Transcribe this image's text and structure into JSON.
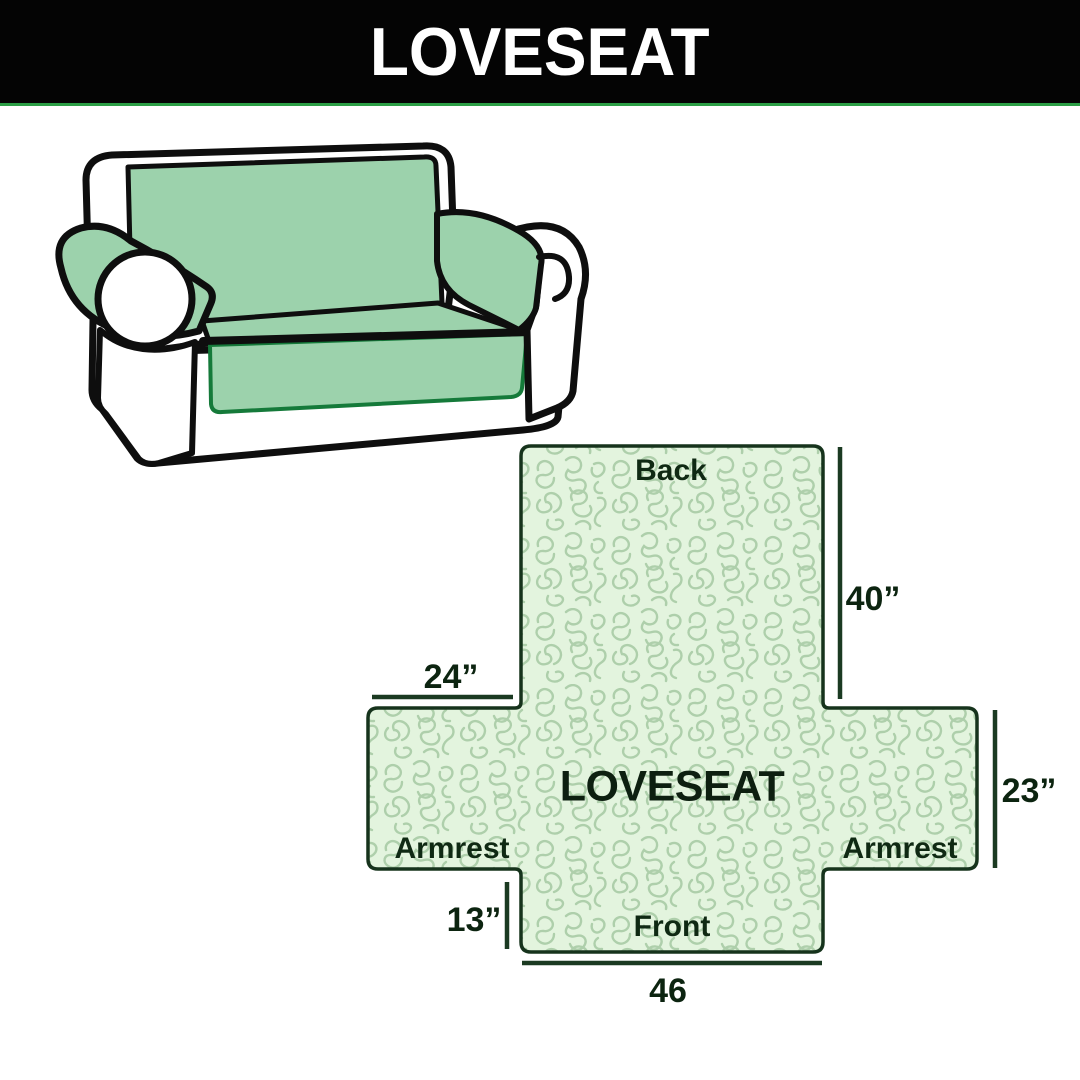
{
  "header": {
    "title": "LOVESEAT"
  },
  "diagram": {
    "center_label": "LOVESEAT",
    "back_label": "Back",
    "front_label": "Front",
    "armrest_left_label": "Armrest",
    "armrest_right_label": "Armrest",
    "dim_back_height": "40”",
    "dim_armrest_top_width": "24”",
    "dim_armrest_side_height": "23”",
    "dim_front_height": "13”",
    "dim_front_width": "46"
  },
  "colors": {
    "header_bg": "#040404",
    "header_text": "#ffffff",
    "header_underline": "#2b9e45",
    "sofa_cover_green": "#9cd2ac",
    "sofa_outline": "#0e0e0e",
    "pattern_background": "#e3f4de",
    "pattern_squiggle": "#aecfab",
    "diagram_outline": "#16331c",
    "label_text": "#0f2913"
  }
}
